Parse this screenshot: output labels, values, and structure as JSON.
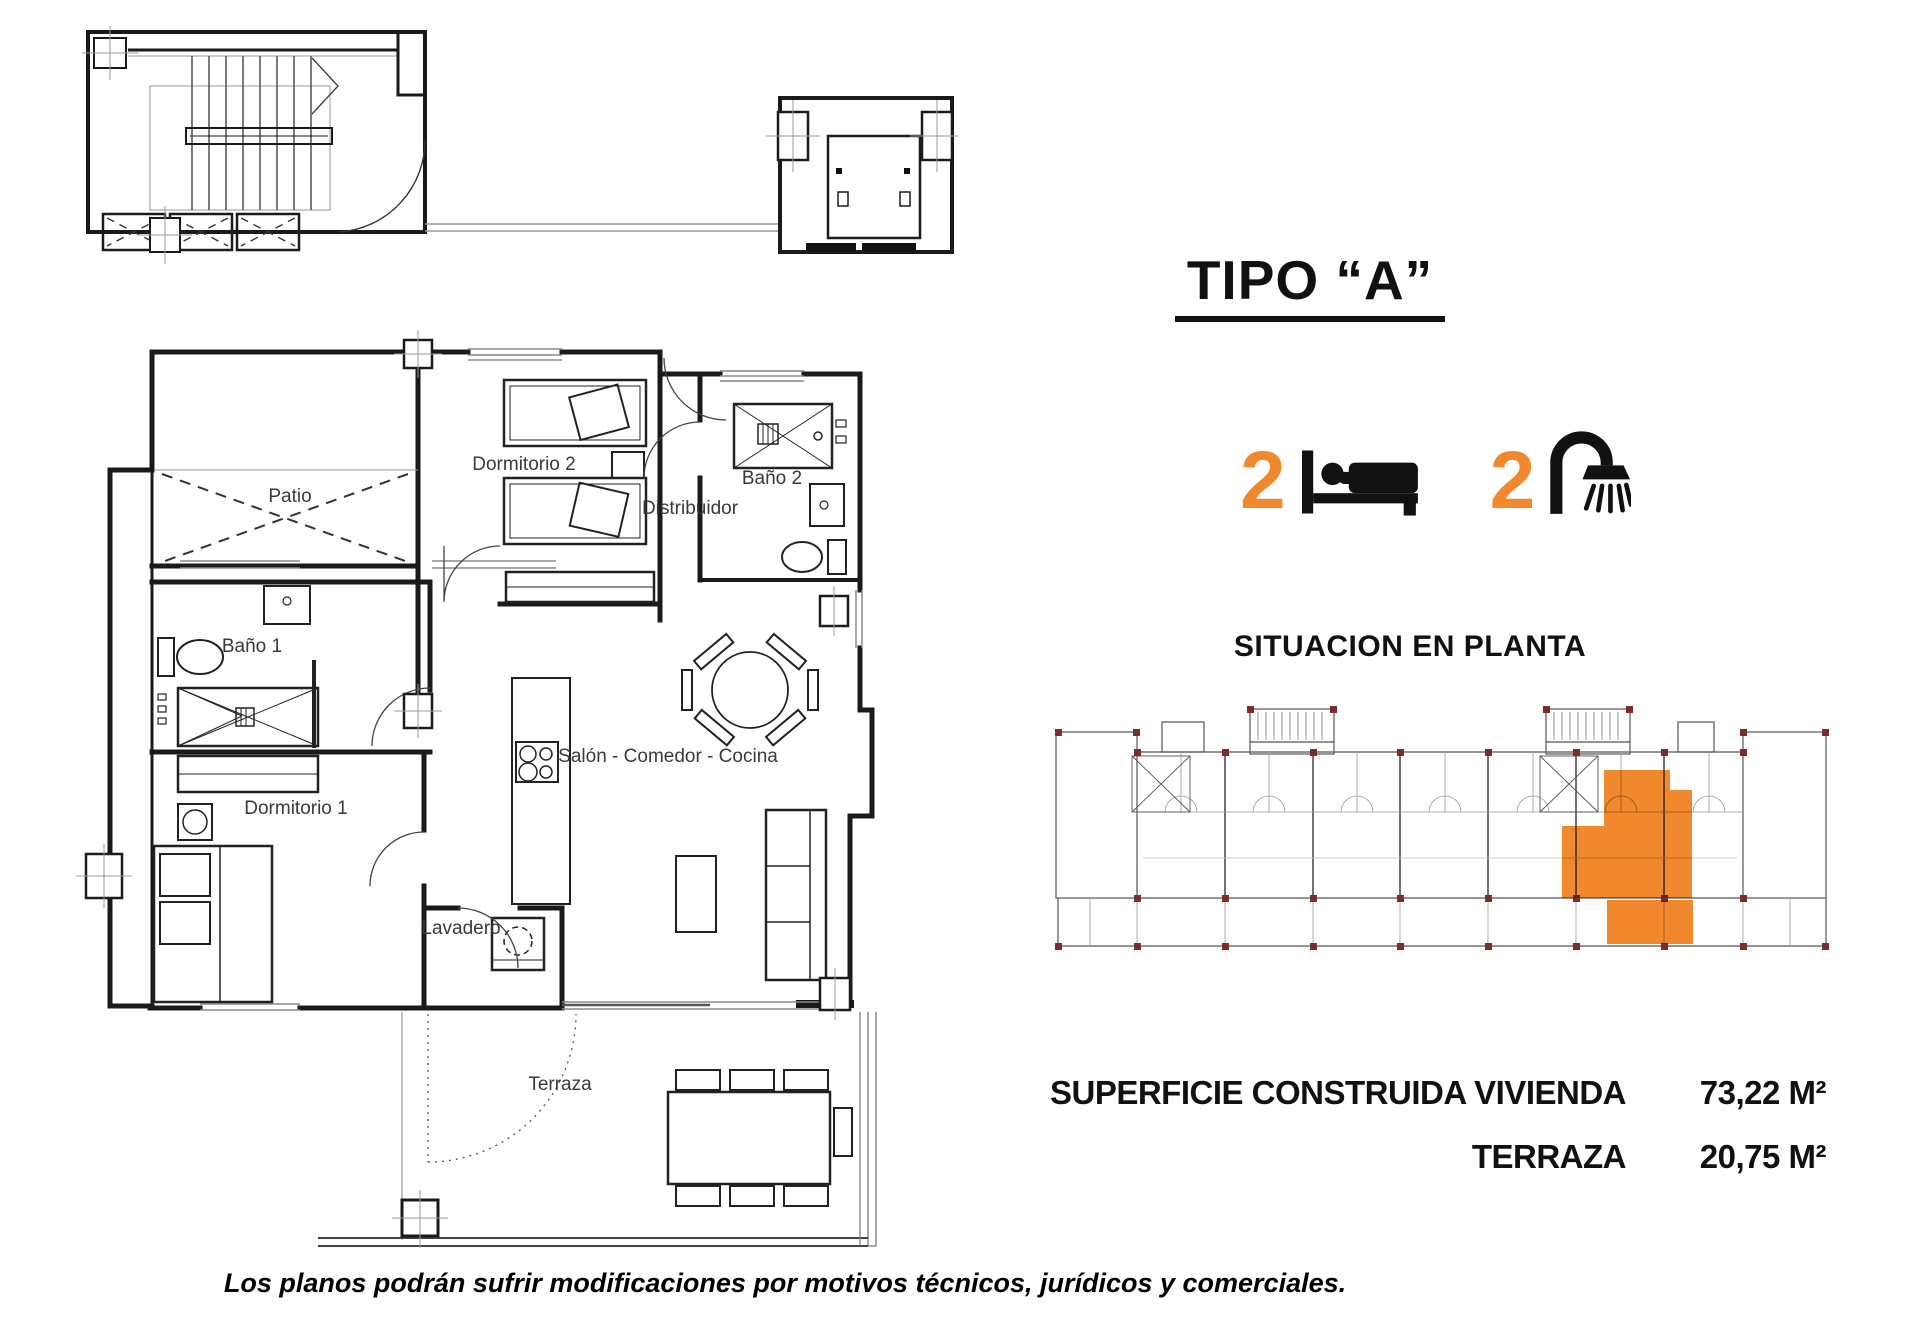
{
  "header": {
    "title": "TIPO “A”",
    "bedrooms": "2",
    "bathrooms": "2",
    "icons": {
      "bedrooms": "bed-icon",
      "bathrooms": "shower-icon"
    }
  },
  "situacion": {
    "heading": "SITUACION EN PLANTA"
  },
  "plan": {
    "rooms": {
      "patio": "Patio",
      "dormitorio2": "Dormitorio 2",
      "bano2": "Baño 2",
      "distribuidor": "Distribuidor",
      "bano1": "Baño 1",
      "dormitorio1": "Dormitorio 1",
      "salon": "Salón - Comedor - Cocina",
      "lavadero": "Lavadero",
      "terraza": "Terraza"
    }
  },
  "areas": {
    "rows": [
      {
        "label": "SUPERFICIE CONSTRUIDA VIVIENDA",
        "value": "73,22 M²"
      },
      {
        "label": "TERRAZA",
        "value": "20,75 M²"
      }
    ]
  },
  "footer": {
    "disclaimer": "Los planos podrán sufrir modificaciones por motivos técnicos, jurídicos y comerciales."
  },
  "colors": {
    "accent": "#F0882D",
    "line": "#1a1a1a",
    "highlight_fill": "#F0882D"
  }
}
